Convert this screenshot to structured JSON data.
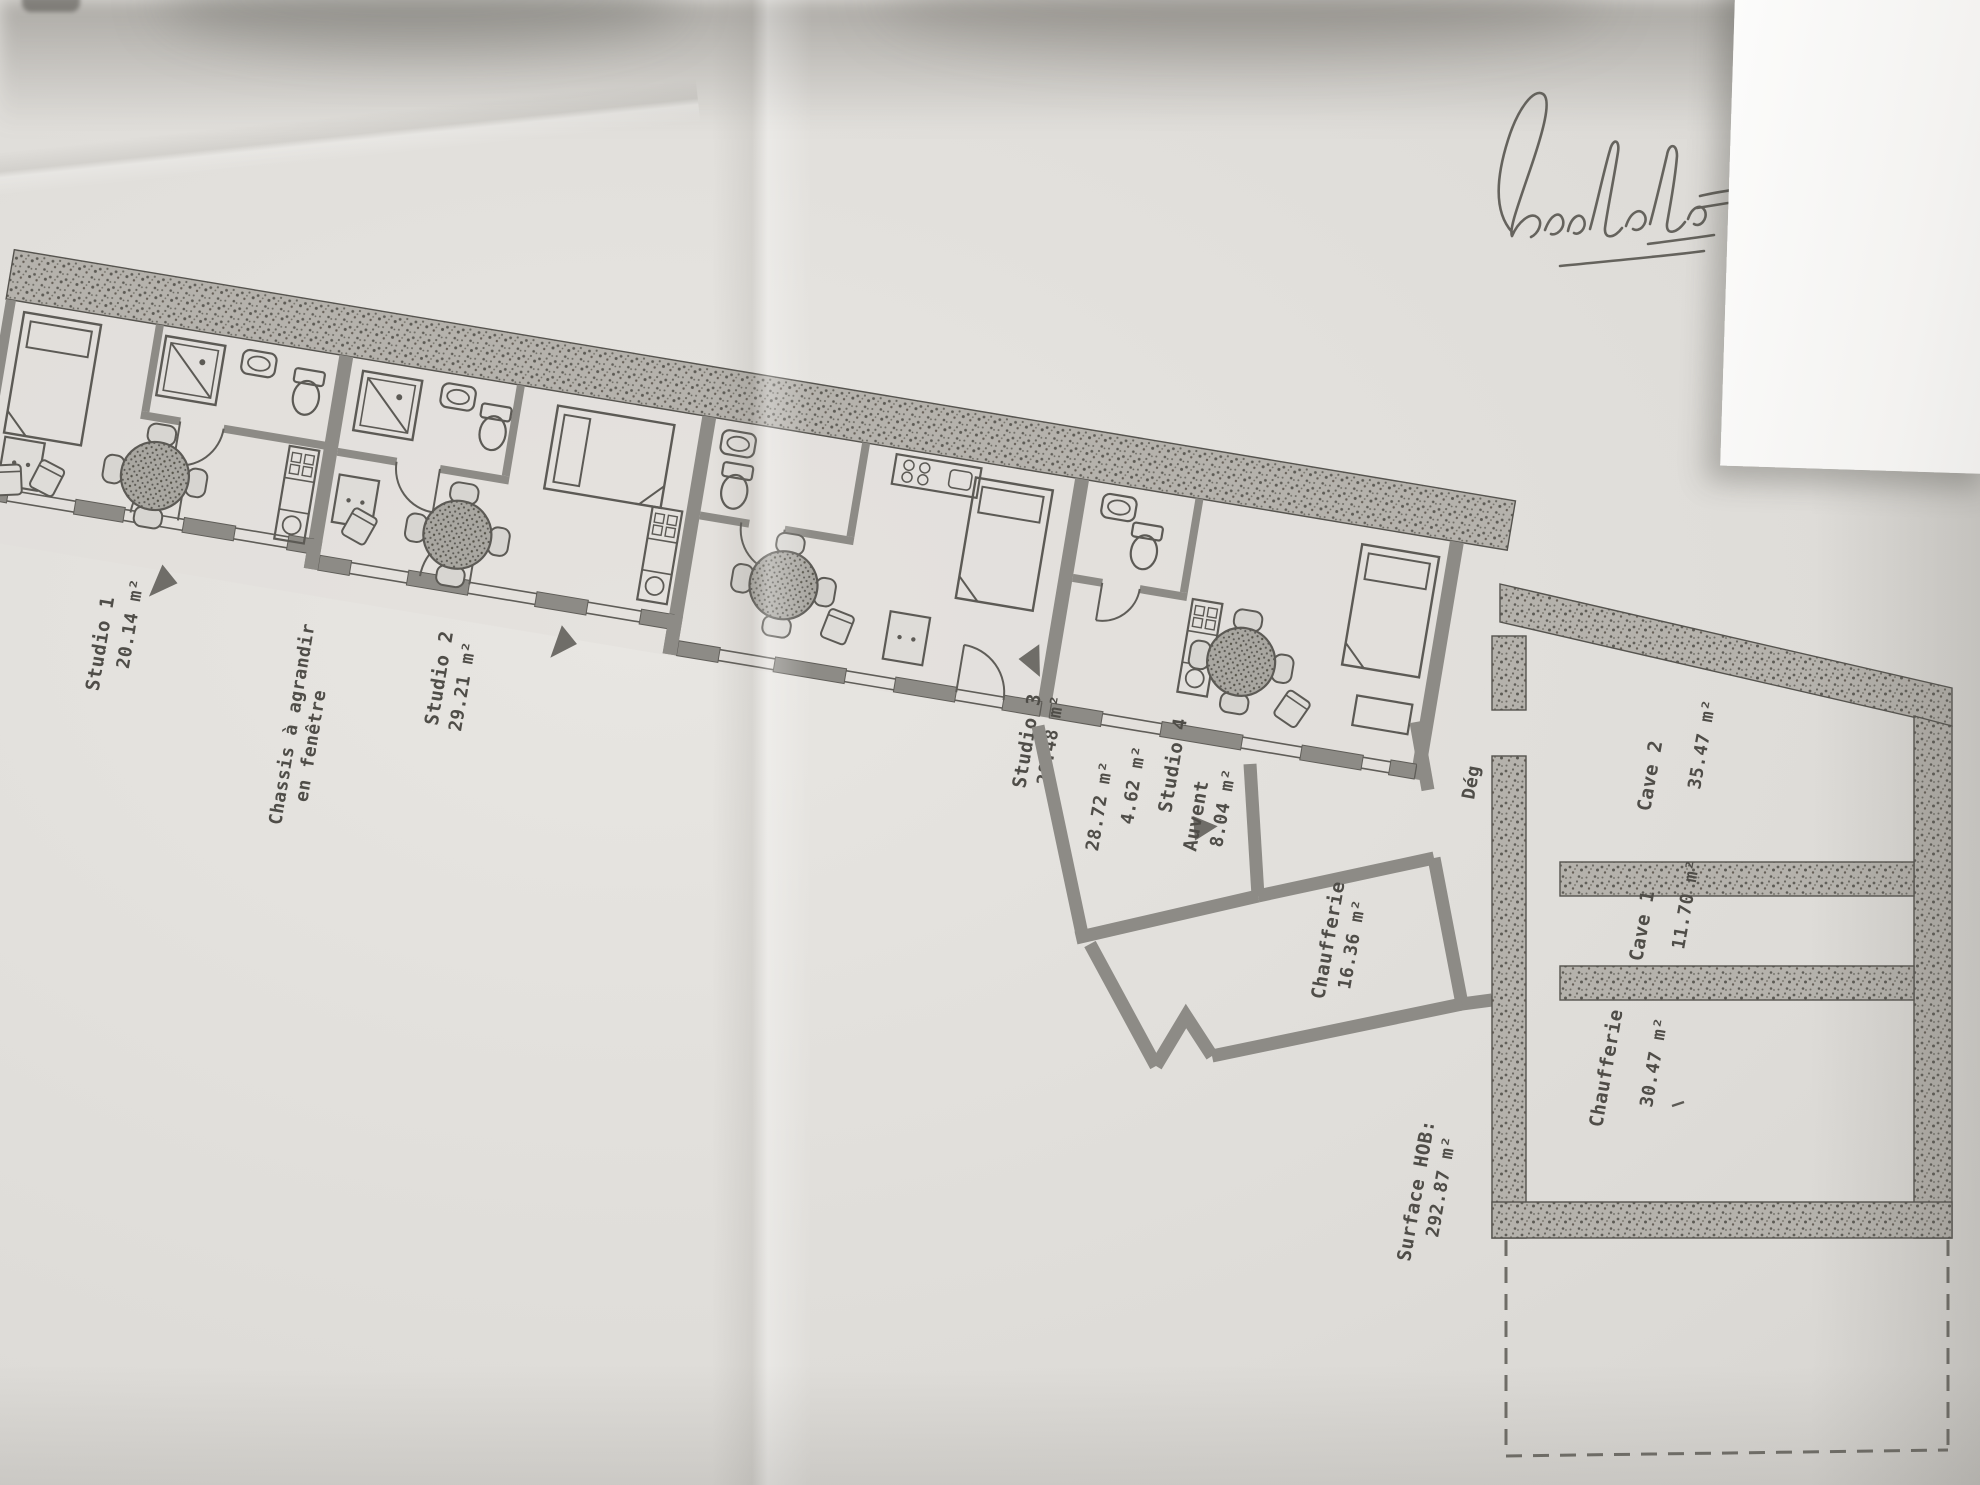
{
  "plan": {
    "studio1": {
      "name": "Studio 1",
      "area": "20.14 m²"
    },
    "studio2": {
      "name": "Studio 2",
      "area": "29.21 m²"
    },
    "studio3": {
      "name": "Studio 3",
      "area": "28.48 m²",
      "area_alt": "28.72 m²"
    },
    "studio4": {
      "name": "Studio 4"
    },
    "wc": {
      "area": "4.62 m²"
    },
    "window_note": {
      "line1": "Chassis à agrandir",
      "line2": "en fenêtre"
    },
    "degagement": {
      "name": "Dég"
    },
    "auvent": {
      "name": "Auvent",
      "area": "8.04 m²"
    },
    "chaufferie_small": {
      "name": "Chaufferie",
      "area": "16.36 m²"
    },
    "cave1": {
      "name": "Cave 1",
      "area": "11.70 m²"
    },
    "cave2": {
      "name": "Cave 2",
      "area": "35.47 m²"
    },
    "chaufferie_basement": {
      "name": "Chaufferie",
      "area": "30.47 m²"
    },
    "total": {
      "label": "Surface HOB:",
      "area": "292.87 m²"
    }
  },
  "colors": {
    "paper": "#dcdad6",
    "ink": "#5c5a55",
    "wall_fill": "#8d8b86",
    "hatch_base": "#b5b2ac"
  }
}
